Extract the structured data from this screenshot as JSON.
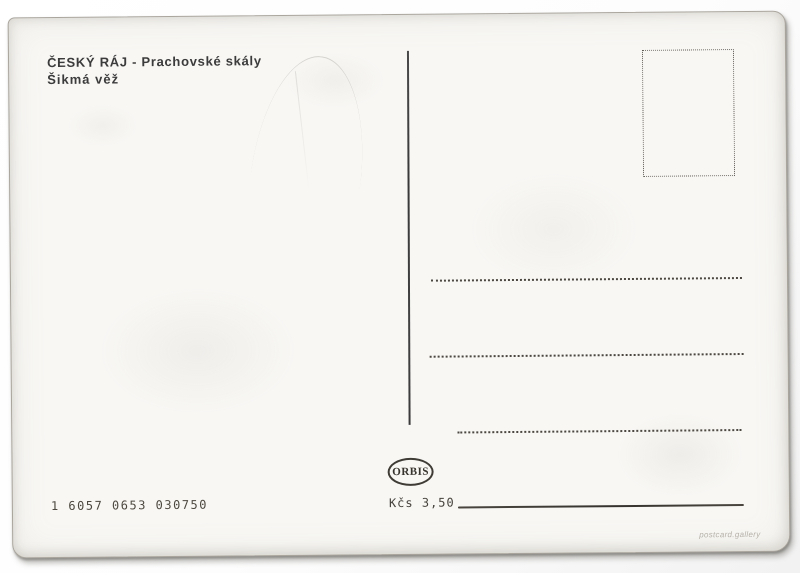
{
  "postcard": {
    "caption": {
      "line1": "ČESKÝ RÁJ - Prachovské skály",
      "line2": "Šikmá věž"
    },
    "publisher": {
      "logo_text": "ORBIS"
    },
    "price_label": "Kčs 3,50",
    "catalog_number": "1 6057 0653 030750",
    "watermark": "postcard.gallery"
  },
  "colors": {
    "ink": "#3b3b3b",
    "paper": "#f8f7f4",
    "scanner_background": "#ffffff",
    "rule_line": "#45413b",
    "dotted_line": "#4c4841",
    "watermark_gray": "#b5b1a9"
  }
}
